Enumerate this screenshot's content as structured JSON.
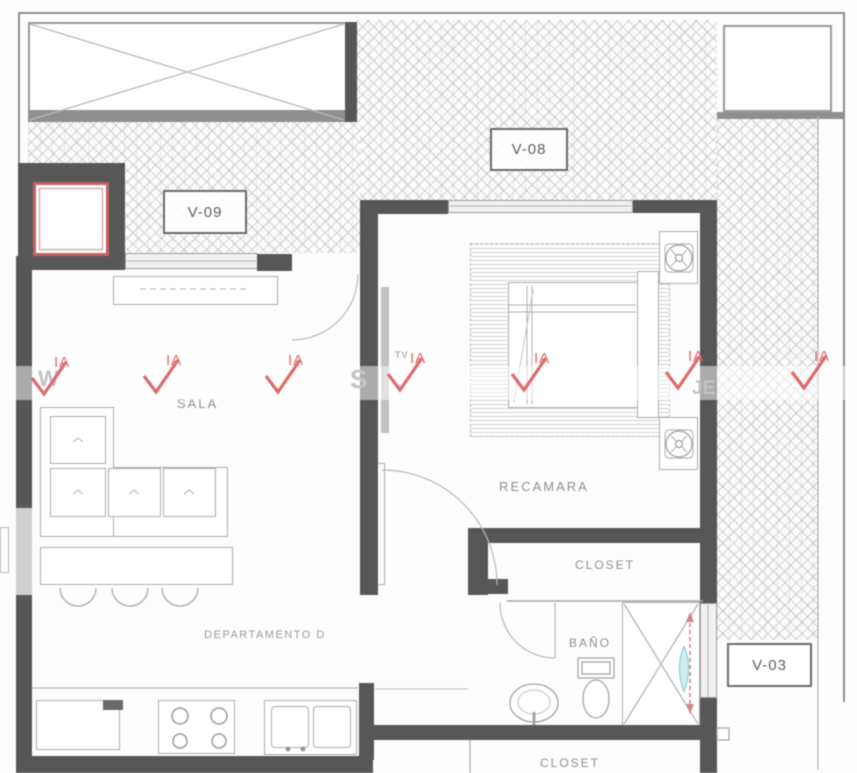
{
  "plan": {
    "unit_label": "DEPARTAMENTO D",
    "rooms": {
      "living": "SALA",
      "bedroom": "RECAMARA",
      "bathroom": "BAÑO",
      "closet_upper": "CLOSET",
      "closet_lower": "CLOSET",
      "tv_label": "TV"
    },
    "window_tags": {
      "v09": "V-09",
      "v08": "V-08",
      "v03": "V-03"
    }
  },
  "watermark": {
    "mark_text": "IA",
    "ghost_left": "W",
    "ghost_mid": "S",
    "ghost_right": "JE",
    "brand_color": "#e06a6a"
  },
  "colors": {
    "wall": "#575757",
    "furniture_line": "#adadad",
    "hatch_line": "#d2d2d2",
    "highlight_red": "#c4605f",
    "window_dim_red": "#d08585",
    "glass_cyan": "#7fcaca"
  }
}
